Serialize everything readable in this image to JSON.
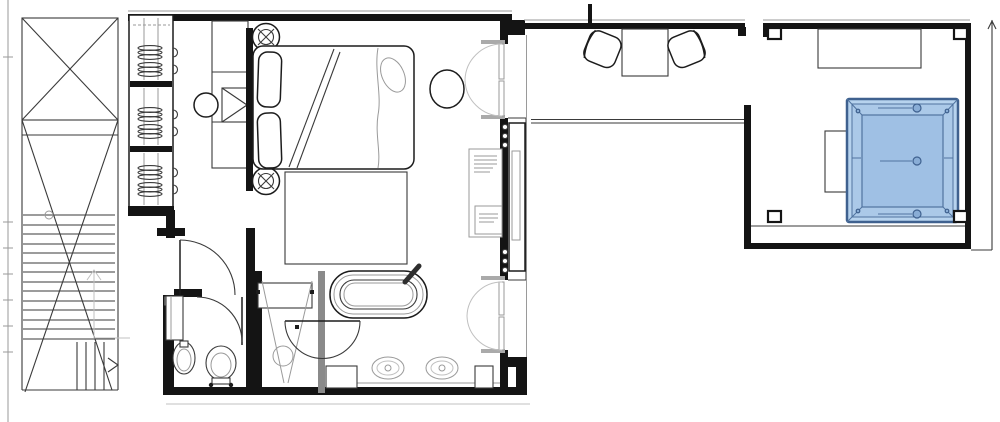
{
  "meta": {
    "document_kind": "architectural floor plan",
    "view": "top-down plan of suite with bedroom, bathroom, balcony corridor and hot-tub terrace"
  },
  "colors": {
    "background": "#ffffff",
    "wall": "#141414",
    "line_medium": "#3a3a3a",
    "line_light": "#9a9a9a",
    "pool_fill_outer": "#b7d3ee",
    "pool_fill_mid": "#abc9e8",
    "pool_fill_inner": "#9fc0e4",
    "pool_stroke": "#3f618f",
    "pool_detail": "#50739f"
  },
  "rooms": [
    {
      "id": "staircase",
      "depicts": "stairwell with cross-braced shaft and up-arrow"
    },
    {
      "id": "wardrobe",
      "depicts": "built-in closet, 3 sections with hanging clothes"
    },
    {
      "id": "bedroom",
      "depicts": "bedroom with double bed, desk, pouf, rug"
    },
    {
      "id": "bathroom",
      "depicts": "bathroom with shower, freestanding tub, double vanity"
    },
    {
      "id": "wc",
      "depicts": "toilet room with basin"
    },
    {
      "id": "balcony",
      "depicts": "balcony corridor with two chairs and table"
    },
    {
      "id": "terrace",
      "depicts": "terrace with square hot tub and benches"
    }
  ],
  "annotation": {
    "note": "tiny illegible specification label attached to right-wall niche"
  }
}
